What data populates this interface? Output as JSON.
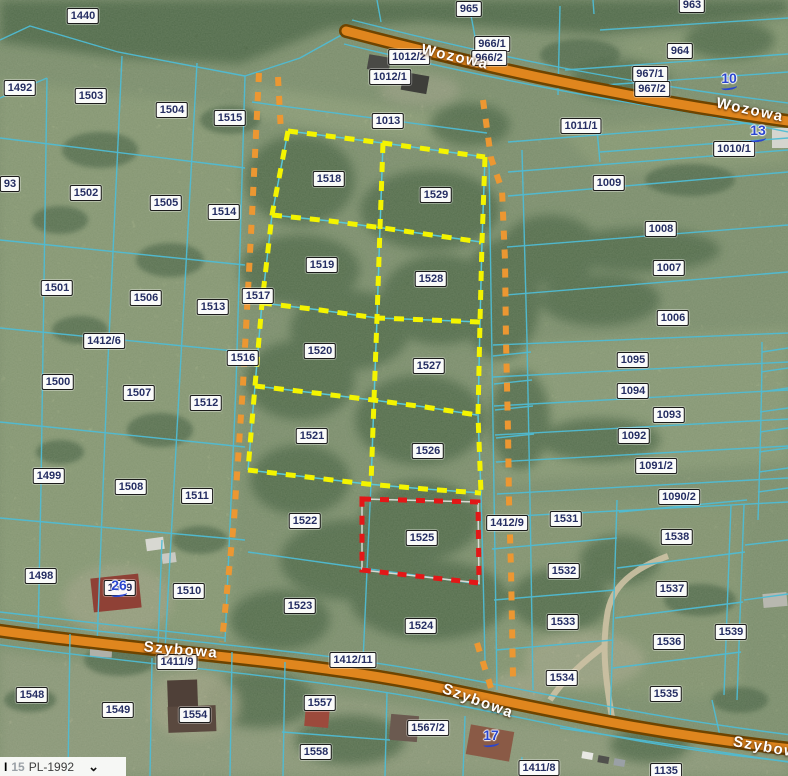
{
  "map": {
    "colors": {
      "c-label-text": "#252e63",
      "c-address": "#2a46cf",
      "c-line": "#4fbcd4",
      "c-road-fill": "#e0861e",
      "c-road-casing": "#6e4400",
      "c-yellow": "#f4f400",
      "c-red": "#e31717",
      "c-orange-dash": "#ec9732"
    },
    "highlighted_parcels": {
      "yellow_group": [
        "1518",
        "1529",
        "1519",
        "1528",
        "1520",
        "1527",
        "1521",
        "1526"
      ],
      "red_parcel": [
        "1525"
      ]
    },
    "road_names": [
      {
        "text": "Wozowa",
        "x": 455,
        "y": 57,
        "angle": 13
      },
      {
        "text": "Wozowa",
        "x": 750,
        "y": 110,
        "angle": 12
      },
      {
        "text": "Szybowa",
        "x": 181,
        "y": 650,
        "angle": 5
      },
      {
        "text": "Szybowa",
        "x": 478,
        "y": 701,
        "angle": 20
      },
      {
        "text": "Szybowa",
        "x": 770,
        "y": 748,
        "angle": 10
      }
    ],
    "address_numbers": [
      {
        "text": "10",
        "x": 729,
        "y": 81
      },
      {
        "text": "13",
        "x": 758,
        "y": 133
      },
      {
        "text": "26",
        "x": 119,
        "y": 588
      },
      {
        "text": "17",
        "x": 491,
        "y": 738
      }
    ],
    "parcel_labels": [
      {
        "text": "1440",
        "x": 83,
        "y": 16
      },
      {
        "text": "965",
        "x": 469,
        "y": 9
      },
      {
        "text": "963",
        "x": 692,
        "y": 5
      },
      {
        "text": "1492",
        "x": 20,
        "y": 88
      },
      {
        "text": "1503",
        "x": 91,
        "y": 96
      },
      {
        "text": "1504",
        "x": 172,
        "y": 110
      },
      {
        "text": "1515",
        "x": 230,
        "y": 118
      },
      {
        "text": "966/1",
        "x": 492,
        "y": 44
      },
      {
        "text": "966/2",
        "x": 489,
        "y": 58
      },
      {
        "text": "1012/2",
        "x": 409,
        "y": 57
      },
      {
        "text": "1012/1",
        "x": 390,
        "y": 77
      },
      {
        "text": "1013",
        "x": 388,
        "y": 121
      },
      {
        "text": "964",
        "x": 680,
        "y": 51
      },
      {
        "text": "967/1",
        "x": 650,
        "y": 74
      },
      {
        "text": "967/2",
        "x": 652,
        "y": 89
      },
      {
        "text": "1011/1",
        "x": 581,
        "y": 126
      },
      {
        "text": "1010/1",
        "x": 734,
        "y": 149
      },
      {
        "text": "93",
        "x": 10,
        "y": 184
      },
      {
        "text": "1502",
        "x": 86,
        "y": 193
      },
      {
        "text": "1505",
        "x": 166,
        "y": 203
      },
      {
        "text": "1514",
        "x": 224,
        "y": 212
      },
      {
        "text": "1518",
        "x": 329,
        "y": 179
      },
      {
        "text": "1529",
        "x": 436,
        "y": 195
      },
      {
        "text": "1009",
        "x": 609,
        "y": 183
      },
      {
        "text": "1008",
        "x": 661,
        "y": 229
      },
      {
        "text": "1007",
        "x": 669,
        "y": 268
      },
      {
        "text": "1006",
        "x": 673,
        "y": 318
      },
      {
        "text": "1519",
        "x": 322,
        "y": 265
      },
      {
        "text": "1528",
        "x": 431,
        "y": 279
      },
      {
        "text": "1517",
        "x": 258,
        "y": 296
      },
      {
        "text": "1501",
        "x": 57,
        "y": 288
      },
      {
        "text": "1506",
        "x": 146,
        "y": 298
      },
      {
        "text": "1513",
        "x": 213,
        "y": 307
      },
      {
        "text": "1412/6",
        "x": 104,
        "y": 341
      },
      {
        "text": "1516",
        "x": 243,
        "y": 358
      },
      {
        "text": "1520",
        "x": 320,
        "y": 351
      },
      {
        "text": "1527",
        "x": 429,
        "y": 366
      },
      {
        "text": "1095",
        "x": 633,
        "y": 360
      },
      {
        "text": "1094",
        "x": 633,
        "y": 391
      },
      {
        "text": "1093",
        "x": 669,
        "y": 415
      },
      {
        "text": "1092",
        "x": 634,
        "y": 436
      },
      {
        "text": "1091/2",
        "x": 656,
        "y": 466
      },
      {
        "text": "1090/2",
        "x": 679,
        "y": 497
      },
      {
        "text": "1500",
        "x": 58,
        "y": 382
      },
      {
        "text": "1507",
        "x": 139,
        "y": 393
      },
      {
        "text": "1512",
        "x": 206,
        "y": 403
      },
      {
        "text": "1521",
        "x": 312,
        "y": 436
      },
      {
        "text": "1526",
        "x": 428,
        "y": 451
      },
      {
        "text": "1499",
        "x": 49,
        "y": 476
      },
      {
        "text": "1508",
        "x": 131,
        "y": 487
      },
      {
        "text": "1511",
        "x": 197,
        "y": 496
      },
      {
        "text": "1498",
        "x": 41,
        "y": 576
      },
      {
        "text": "1509",
        "x": 120,
        "y": 588
      },
      {
        "text": "1510",
        "x": 189,
        "y": 591
      },
      {
        "text": "1522",
        "x": 305,
        "y": 521
      },
      {
        "text": "1525",
        "x": 422,
        "y": 538
      },
      {
        "text": "1412/9",
        "x": 507,
        "y": 523
      },
      {
        "text": "1531",
        "x": 566,
        "y": 519
      },
      {
        "text": "1538",
        "x": 677,
        "y": 537
      },
      {
        "text": "1532",
        "x": 564,
        "y": 571
      },
      {
        "text": "1537",
        "x": 672,
        "y": 589
      },
      {
        "text": "1533",
        "x": 563,
        "y": 622
      },
      {
        "text": "1539",
        "x": 731,
        "y": 632
      },
      {
        "text": "1536",
        "x": 669,
        "y": 642
      },
      {
        "text": "1534",
        "x": 562,
        "y": 678
      },
      {
        "text": "1535",
        "x": 666,
        "y": 694
      },
      {
        "text": "1523",
        "x": 300,
        "y": 606
      },
      {
        "text": "1524",
        "x": 421,
        "y": 626
      },
      {
        "text": "1412/11",
        "x": 353,
        "y": 660
      },
      {
        "text": "1411/9",
        "x": 177,
        "y": 662
      },
      {
        "text": "1548",
        "x": 32,
        "y": 695
      },
      {
        "text": "1549",
        "x": 118,
        "y": 710
      },
      {
        "text": "1554",
        "x": 195,
        "y": 715
      },
      {
        "text": "1557",
        "x": 320,
        "y": 703
      },
      {
        "text": "1558",
        "x": 316,
        "y": 752
      },
      {
        "text": "1567/2",
        "x": 428,
        "y": 728
      },
      {
        "text": "1411/8",
        "x": 539,
        "y": 768
      },
      {
        "text": "1135",
        "x": 666,
        "y": 771
      }
    ],
    "crs_bar": {
      "cursor": "I",
      "scale_prefix": "15",
      "crs": "PL-1992",
      "chevron": "⌄"
    }
  }
}
